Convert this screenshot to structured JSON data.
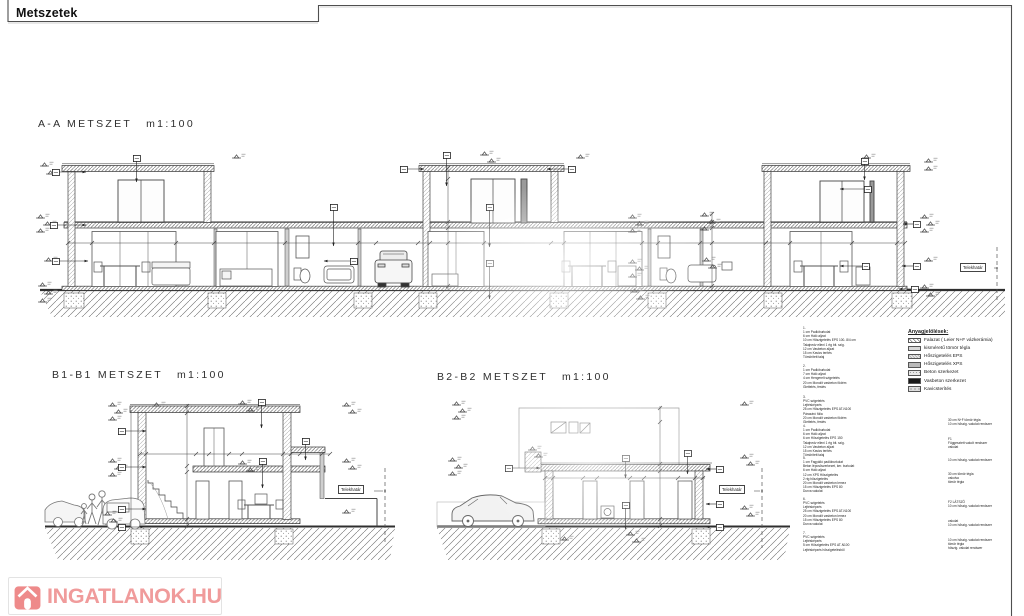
{
  "sheet": {
    "title": "Metszetek"
  },
  "sections": [
    {
      "label": "A-A METSZET",
      "scale": "m1:100"
    },
    {
      "label": "B1-B1 METSZET",
      "scale": "m1:100"
    },
    {
      "label": "B2-B2 METSZET",
      "scale": "m1:100"
    }
  ],
  "boundary_label": "Telekhatár",
  "legend": {
    "title": "Anyagjelölések:",
    "items": [
      {
        "swatch": "hatch",
        "label": "Falazat ( Leier N+F vázkerámia)"
      },
      {
        "swatch": "ltgray",
        "label": "kisméretű tömör tégla"
      },
      {
        "swatch": "eps",
        "label": "Hőszigetelés EPS"
      },
      {
        "swatch": "xps",
        "label": "Hőszigetelés XPS"
      },
      {
        "swatch": "beton",
        "label": "Beton szerkezet"
      },
      {
        "swatch": "vasbeton",
        "label": "Vasbeton szerkezet"
      },
      {
        "swatch": "kavics",
        "label": "Kavicsterítés"
      }
    ]
  },
  "notes_left": {
    "groups": [
      {
        "top": 326,
        "lines": [
          "1.",
          "1 cm Padlóburkolat",
          "6 cm Háló aljzat",
          "10 cm Hőszigetelés EPS 100- 8/4 cm",
          "Talajnedv elleni 1 rtg bit. szig.",
          "12 cm Vasbeton aljzat",
          "15 cm Kavics terítés",
          "Tömörített talaj"
        ]
      },
      {
        "top": 364,
        "lines": [
          "2.",
          "1 cm Padlóburkolat",
          "7 cm Háló aljzat",
          "4 cm Hengerelt szigetelés",
          "20 cm Monolit vasbeton födém",
          "Glettelés, festés"
        ]
      },
      {
        "top": 395,
        "lines": [
          "3.",
          "PVC szigetelés",
          "Lejtésképzés",
          "25 cm Hőszigetelés EPS AT-N100",
          "Párazáró fólia",
          "20 cm Monolit vasbeton födém",
          "Glettelés, festés"
        ]
      },
      {
        "top": 424,
        "lines": [
          "4.",
          "1 cm Padlóburkolat",
          "6 cm Háló aljzat",
          "6 cm Hőszigetelés EPS 150",
          "Talajnedv elleni 1 rtg bit. szig.",
          "12 cm Vasbeton aljzat",
          "15 cm Kavics terítés",
          "Tömörített talaj"
        ]
      },
      {
        "top": 456,
        "lines": [
          "5.",
          "1 cm Fagyálló padlóburkolat",
          "Beton lépcsőszerkezet, ker. burkolat",
          "6 cm Háló aljzat",
          "12 cm XPS Hőszigetelés",
          "2 rtg hőszigetelés",
          "20 cm Monolit vasbeton lemez",
          "15 cm Hőszigetelés EPS 80",
          "Durva vakolat"
        ]
      },
      {
        "top": 497,
        "lines": [
          "6.",
          "PVC szigetelés",
          "Lejtésképzés",
          "25 cm Hőszigetelés EPS AT-N100",
          "20 cm Monolit vasbeton lemez",
          "15 cm Hőszigetelés EPS 80",
          "Durva vakolat"
        ]
      },
      {
        "top": 531,
        "lines": [
          "7.",
          "PVC szigetelés",
          "Lejtésképzés",
          "5 cm Hőszigetelés EPS AT-N100",
          "Lejtésképzés hőszigetelésből"
        ]
      }
    ]
  },
  "notes_right": {
    "groups": [
      {
        "top": 418,
        "lines": [
          "30 cm N+F tömör tégla",
          "10 cm hőszig. vakolat rendszer"
        ]
      },
      {
        "top": 437,
        "lines": [
          "F1",
          "Függesztett vakolt rendszer",
          "vakolat"
        ]
      },
      {
        "top": 458,
        "lines": [
          "10 cm hőszig. vakolat rendszer"
        ]
      },
      {
        "top": 472,
        "lines": [
          "30 cm tömör tégla",
          "vakolva",
          "tömör tégla"
        ]
      },
      {
        "top": 500,
        "lines": [
          "F2 LÁTSZÓ",
          "10 cm hőszig. vakolat rendszer"
        ]
      },
      {
        "top": 519,
        "lines": [
          "vakolat",
          "10 cm hőszig. vakolat rendszer"
        ]
      },
      {
        "top": 538,
        "lines": [
          "10 cm hőszig. vakolat rendszer",
          "tömör tégla",
          "hőszig. vakolat rendszer"
        ]
      }
    ]
  },
  "watermark": {
    "text": "INGATLANOK.HU",
    "color": "#f09b9b",
    "icon_color": "#ee8a8a"
  },
  "colors": {
    "line": "#3d3d3d",
    "ground_hatch": "#6b6b6b"
  }
}
